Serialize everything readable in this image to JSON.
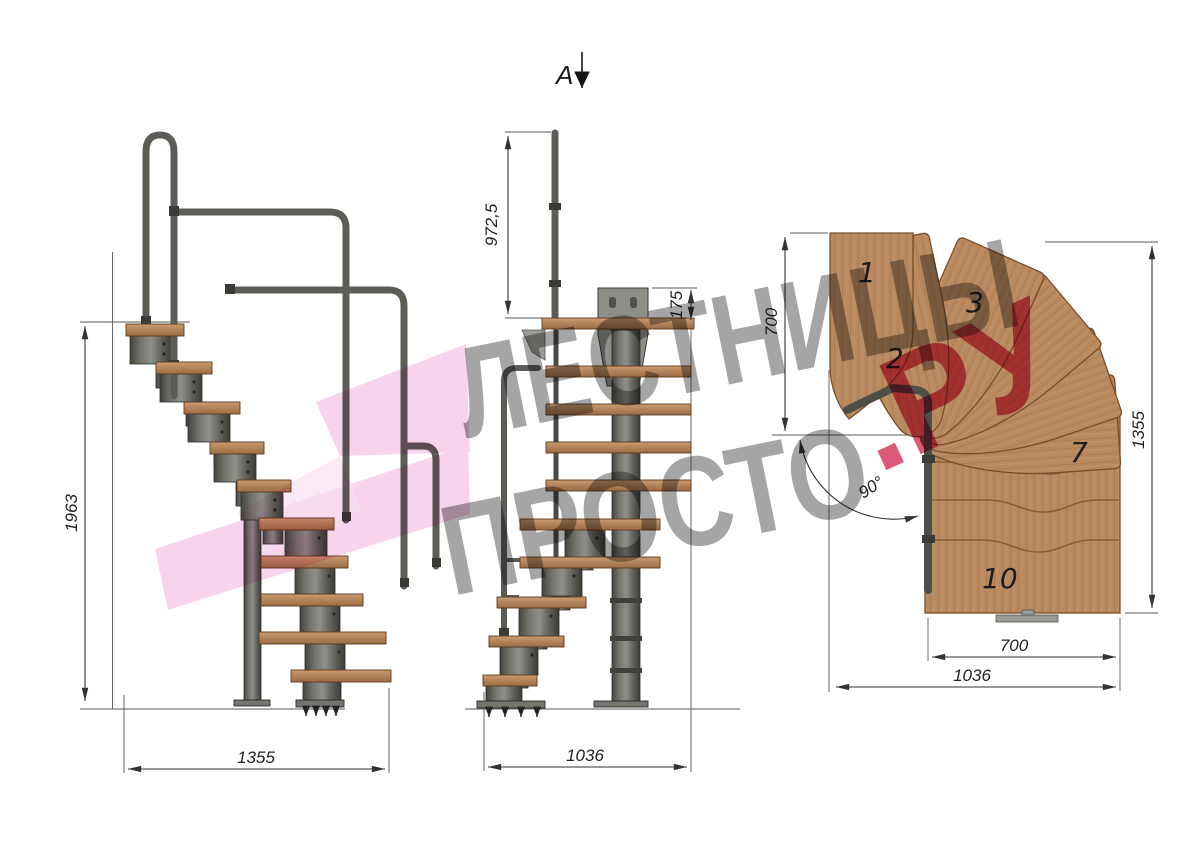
{
  "watermark": {
    "line1": "ЛЕСТНИЦЫ",
    "line2": "ПРОСТО",
    "suffix": ".РУ",
    "text_color": "#8f8f8f",
    "suffix_color": "#d63c63",
    "logo_color": "#f2aedd"
  },
  "section_marker": {
    "label": "A"
  },
  "side_view": {
    "dim_height": "1963",
    "dim_width": "1355"
  },
  "front_view": {
    "dim_rail_height": "972,5",
    "dim_bracket": "175",
    "dim_width": "1036"
  },
  "plan_view": {
    "dim_entry_depth": "700",
    "dim_length": "1355",
    "dim_flight_width": "700",
    "dim_width": "1036",
    "angle": "90°",
    "steps": {
      "s1": "1",
      "s2": "2",
      "s3": "3",
      "s7": "7",
      "s10": "10"
    }
  },
  "colors": {
    "wood": "#b9875f",
    "wood_edge": "#7a4e2a",
    "metal": "#62625d",
    "metal_dark": "#3a3a37",
    "dimension_line": "#333333"
  }
}
